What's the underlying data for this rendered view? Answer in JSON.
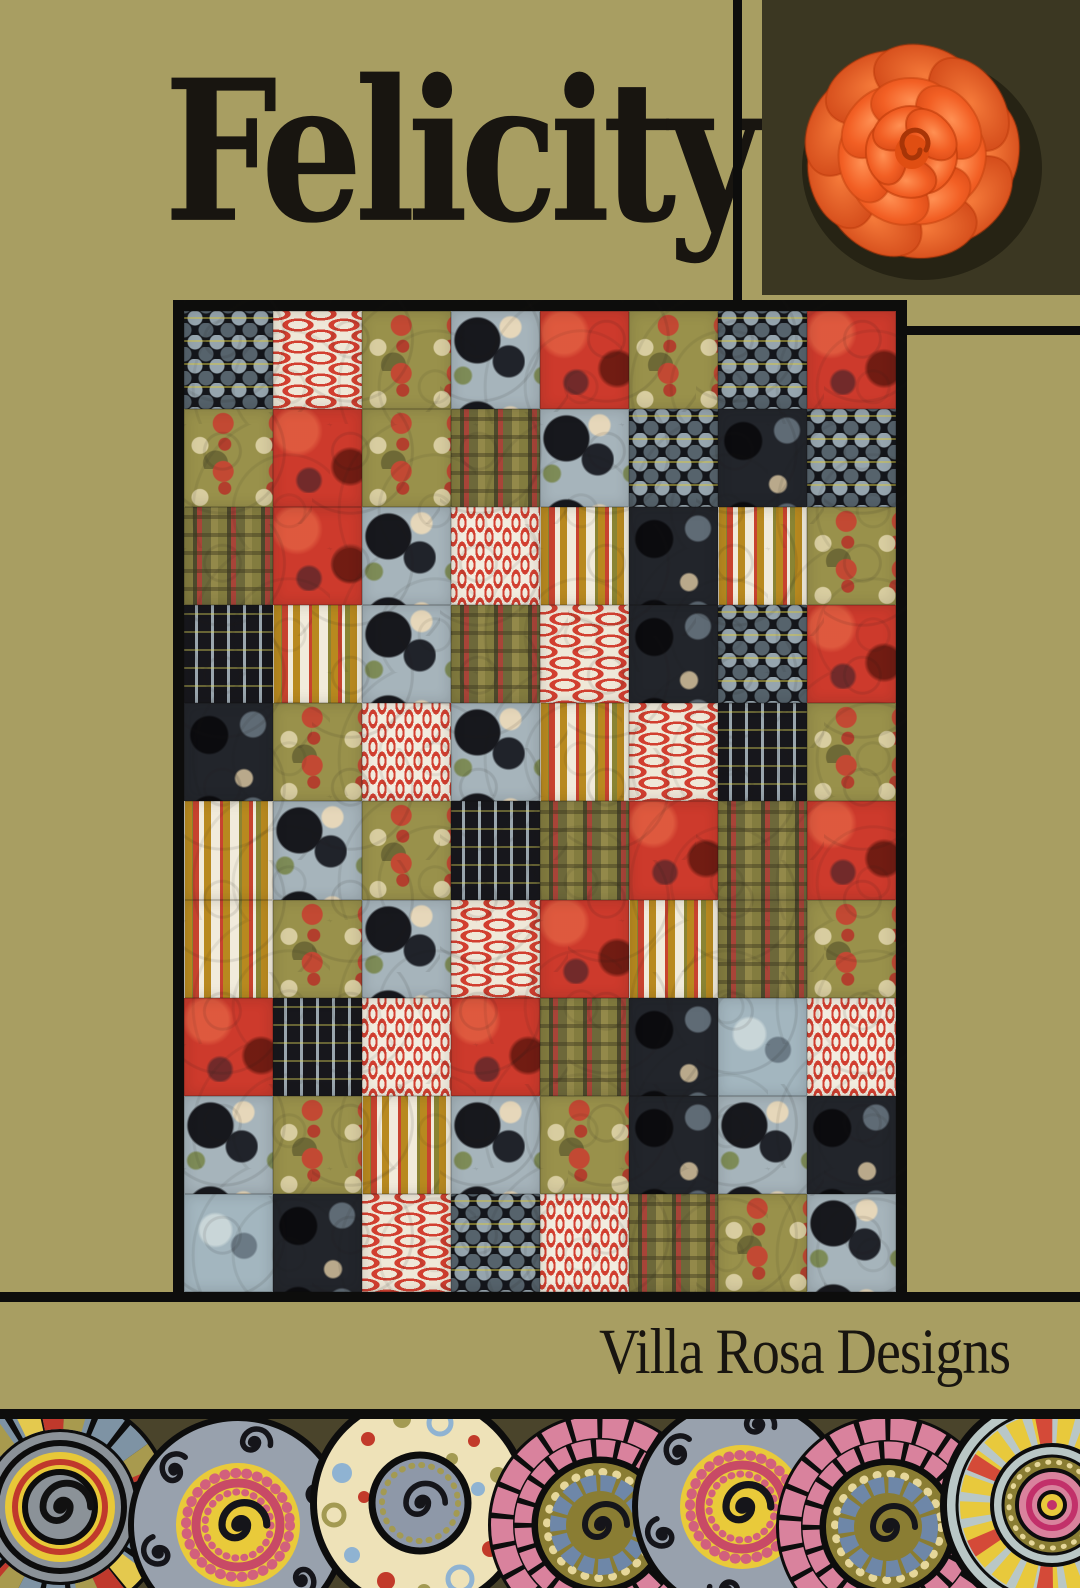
{
  "header": {
    "title": "Felicity"
  },
  "footer": {
    "brand": "Villa Rosa Designs"
  },
  "palette": {
    "khaki": "#a89e62",
    "dark_olive": "#3b3722",
    "band_olive": "#4a442b",
    "line_black": "#0d0d0c",
    "text_black": "#181510",
    "rose_orange": "#f25f24",
    "rose_deep": "#cc3f10",
    "rose_light": "#ff9053",
    "fabric_red": "#cd3a2c",
    "fabric_cream": "#efe8d8",
    "fabric_olive": "#99914b",
    "fabric_bluegray": "#a6b4bb"
  },
  "quilt": {
    "grid": [
      [
        "scallop",
        "capsule",
        "camo",
        "poppy",
        "red",
        "camo",
        "scallop",
        "red"
      ],
      [
        "camo",
        "red",
        "camo",
        "plaid",
        "poppy",
        "scallop",
        "dark",
        "scallop"
      ],
      [
        "plaid",
        "red",
        "poppy",
        "dashv",
        "glyph",
        "dark",
        "glyph",
        "camo"
      ],
      [
        "stripe",
        "glyph",
        "poppy",
        "plaid",
        "capsule",
        "dark",
        "scallop",
        "red"
      ],
      [
        "dark",
        "camo",
        "dashv",
        "poppy",
        "glyph",
        "capsule",
        "stripe",
        "camo"
      ],
      [
        "glyph",
        "poppy",
        "camo",
        "stripe",
        "plaid",
        "red",
        "plaid",
        "red"
      ],
      [
        "glyph",
        "camo",
        "poppy",
        "capsule",
        "red",
        "glyph",
        "plaid",
        "camo"
      ],
      [
        "red",
        "stripe",
        "dashv",
        "red",
        "plaid",
        "dark",
        "blue",
        "dashv"
      ],
      [
        "poppy",
        "camo",
        "glyph",
        "poppy",
        "camo",
        "dark",
        "poppy",
        "dark"
      ],
      [
        "blue",
        "dark",
        "capsule",
        "scallop",
        "dashv",
        "plaid",
        "camo",
        "poppy"
      ]
    ]
  },
  "border": {
    "circles": [
      {
        "x": 60,
        "y": 88,
        "design": "mosaic"
      },
      {
        "x": 238,
        "y": 106,
        "design": "grayspiral"
      },
      {
        "x": 420,
        "y": 84,
        "design": "creamdots"
      },
      {
        "x": 600,
        "y": 106,
        "design": "pinkmosaic"
      },
      {
        "x": 742,
        "y": 88,
        "design": "grayspiral"
      },
      {
        "x": 888,
        "y": 108,
        "design": "pinkmosaic"
      },
      {
        "x": 1052,
        "y": 86,
        "design": "spoke"
      }
    ]
  }
}
